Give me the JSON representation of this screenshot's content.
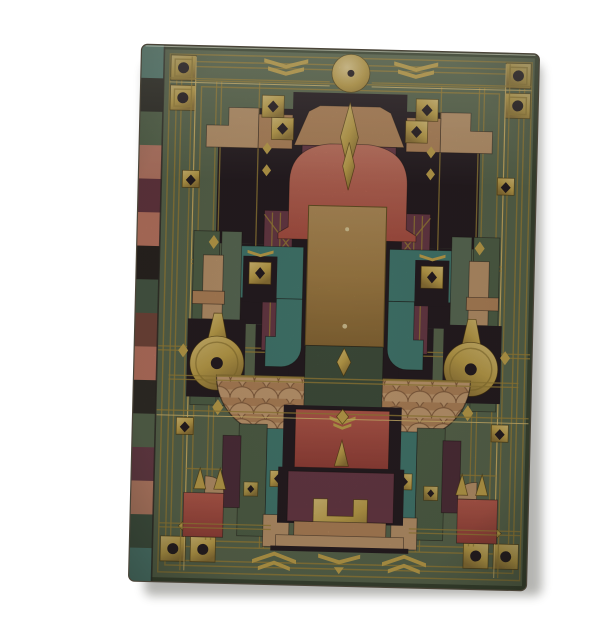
{
  "page": {
    "background_color": "#ffffff"
  },
  "journal": {
    "description": "Hardcover journal with symmetric Prairie-style ornamental cover: mottled green ground, gold pinstripe grid and frames, gold disc finial, central gilt panel, keyhole balloon medallions, fish-scale fans, salmon and maroon panels with a gold H motif, stud-square corners, chevron borders and a multicolored spine edge.",
    "palette": {
      "pageBg": "#ffffff",
      "coverGreen": "#5f6c52",
      "coverGreenDark": "#475440",
      "borderEdge": "#3a4531",
      "gold": "#c9a94f",
      "goldBright": "#e0c375",
      "goldDeep": "#8e7430",
      "goldLine": "#a3873b",
      "copper": "#ba8a5e",
      "copperLight": "#cda377",
      "copperDark": "#8a6140",
      "tan": "#c49b70",
      "salmon": "#c4695c",
      "red": "#b5564a",
      "maroon": "#6e3c49",
      "maroonDeep": "#53303d",
      "dark": "#281e23",
      "darkGreen": "#445340",
      "greenStripe": "#55664c",
      "greenStripeLight": "#60715a",
      "teal": "#477f75",
      "shadow": "#3c3c36"
    },
    "spine_segments": [
      "#5f8b80",
      "#2f2d28",
      "#5a6a50",
      "#c4806c",
      "#6b3a44",
      "#c97e68",
      "#2b2622",
      "#4d5f4a",
      "#7a4a3e",
      "#c57a66",
      "#332f29",
      "#5c6b52",
      "#6d3f4a",
      "#c8876e",
      "#465847",
      "#56867c"
    ],
    "motifs": [
      "gold-disc-finial",
      "stepped-roof",
      "obelisk-diamonds",
      "salmon-arch",
      "central-gilt-panel",
      "keyhole-balloons",
      "fish-scale-fans",
      "ziggurat-pedestal",
      "gilt-h-medallion",
      "corner-stud-squares",
      "border-chevrons",
      "pinstripe-grid"
    ]
  }
}
